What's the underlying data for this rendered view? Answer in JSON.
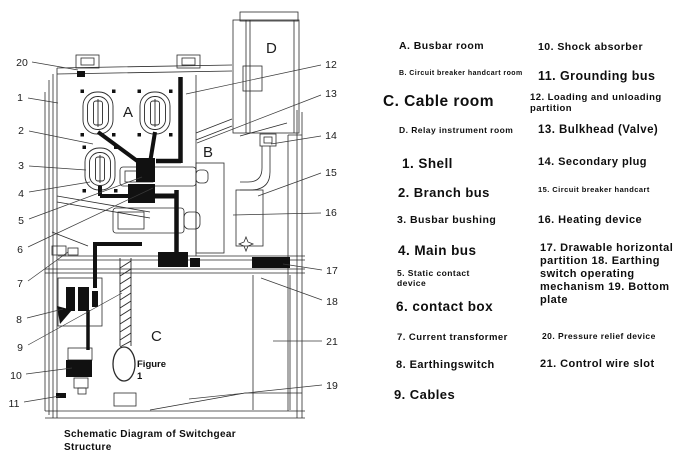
{
  "figure": {
    "caption": "Schematic Diagram of Switchgear Structure",
    "figure_note": "Figure 1",
    "room_labels": [
      "A",
      "B",
      "C",
      "D"
    ],
    "callout_numbers_left": [
      "20",
      "1",
      "2",
      "3",
      "4",
      "5",
      "6",
      "7",
      "8",
      "9",
      "10",
      "11"
    ],
    "callout_numbers_right": [
      "12",
      "13",
      "14",
      "15",
      "16",
      "17",
      "18",
      "21",
      "19"
    ]
  },
  "legend": {
    "column1": [
      {
        "text": "A. Busbar room"
      },
      {
        "text": "B. Circuit breaker handcart room"
      },
      {
        "text": "C. Cable room"
      },
      {
        "text": "D. Relay instrument room"
      },
      {
        "text": "1. Shell"
      },
      {
        "text": "2. Branch bus"
      },
      {
        "text": "3. Busbar bushing"
      },
      {
        "text": "4. Main bus"
      },
      {
        "text": "5. Static contact device"
      },
      {
        "text": "6. contact box"
      },
      {
        "text": "7. Current transformer"
      },
      {
        "text": "8. Earthingswitch"
      },
      {
        "text": "9. Cables"
      }
    ],
    "column2": [
      {
        "text": "10. Shock absorber"
      },
      {
        "text": "11. Grounding bus"
      },
      {
        "text": "12. Loading and unloading partition"
      },
      {
        "text": "13. Bulkhead (Valve)"
      },
      {
        "text": "14. Secondary plug"
      },
      {
        "text": "15. Circuit breaker handcart"
      },
      {
        "text": "16. Heating device"
      },
      {
        "text": "17. Drawable horizontal partition 18. Earthing switch operating mechanism 19. Bottom plate"
      },
      {
        "text": "20. Pressure relief device"
      },
      {
        "text": "21. Control wire slot"
      }
    ]
  }
}
